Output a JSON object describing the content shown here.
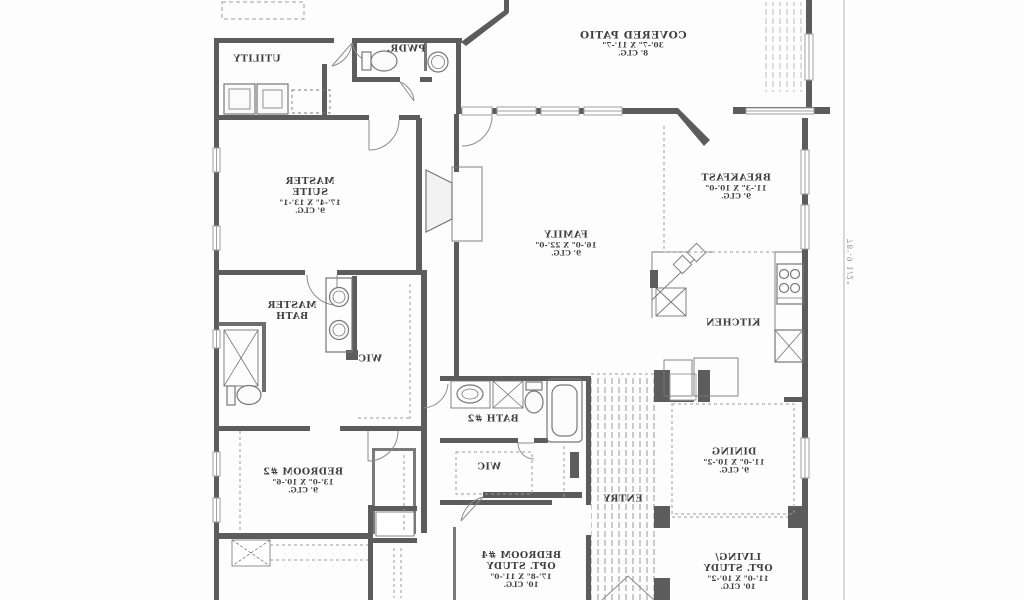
{
  "colors": {
    "wall": "#5c5c5c",
    "thin_line": "#8c8c8c",
    "text": "#3f3f3f",
    "background": "#fdfdfd"
  },
  "rooms": {
    "covered_patio": {
      "lines": [
        "COVERED PATIO",
        "30'-7\" X 11'-7\"",
        "8' CLG."
      ]
    },
    "utility": {
      "lines": [
        "UTILITY"
      ]
    },
    "pwdr": {
      "lines": [
        "PWDR."
      ]
    },
    "master_suite": {
      "lines": [
        "MASTER",
        "SUITE",
        "17'-4\" X 13'-1\"",
        "9' CLG."
      ]
    },
    "family": {
      "lines": [
        "FAMILY",
        "16'-0\" X 22'-0\"",
        "9' CLG."
      ]
    },
    "breakfast": {
      "lines": [
        "BREAKFAST",
        "11'-3\" X 10'-0\"",
        "9' CLG."
      ]
    },
    "kitchen": {
      "lines": [
        "KITCHEN"
      ]
    },
    "master_bath": {
      "lines": [
        "MASTER",
        "BATH"
      ]
    },
    "wic_master": {
      "lines": [
        "WIC"
      ]
    },
    "bath2": {
      "lines": [
        "BATH #2"
      ]
    },
    "wic_hall": {
      "lines": [
        "WIC"
      ]
    },
    "entry": {
      "lines": [
        "ENTRY"
      ]
    },
    "dining": {
      "lines": [
        "DINING",
        "11'-0\" X 10'-2\"",
        "9' CLG."
      ]
    },
    "living": {
      "lines": [
        "LIVING/",
        "OPT. STUDY",
        "11'-0\" X 10'-2\"",
        "10' CLG."
      ]
    },
    "bedroom2": {
      "lines": [
        "BEDROOM #2",
        "13'-0\" X 10'-6\"",
        "9' CLG."
      ]
    },
    "bedroom4": {
      "lines": [
        "BEDROOM #4",
        "OPT. STUDY",
        "17'-8\" X 11'-0\"",
        "10' CLG."
      ]
    }
  },
  "dimension": {
    "lot_depth": "78'-9 1/2\""
  }
}
